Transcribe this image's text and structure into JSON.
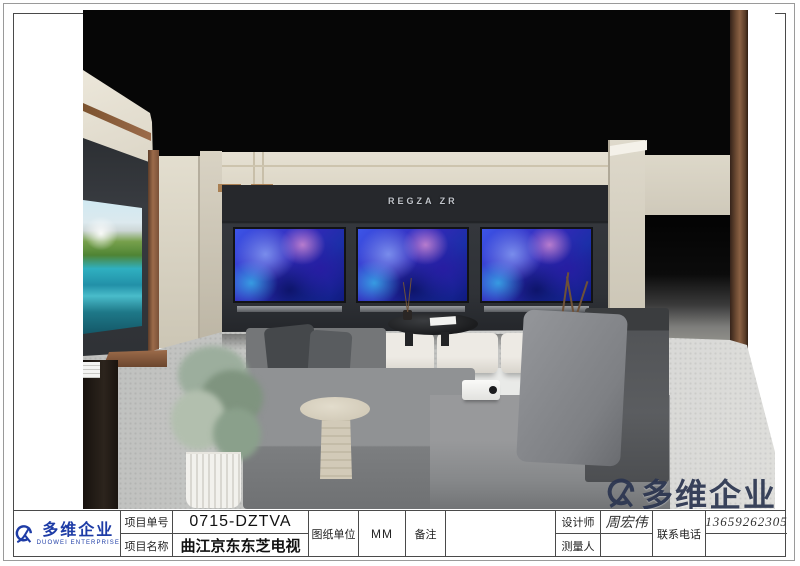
{
  "scene": {
    "brand_sign": "REGZA ZR",
    "watermark_text": "多维企业",
    "colors": {
      "logo_blue": "#1e3ca6",
      "watermark_navy": "#2b3550",
      "feature_wall_charcoal": "#2f3237",
      "wall_beige": "#e0dbcc",
      "copper_trim": "#8a5f42",
      "tv_art_blue": "#3328b8",
      "floor_gray": "#c8c9c7"
    }
  },
  "title_block": {
    "logo": {
      "name_cn": "多维企业",
      "name_en": "DUOWEI ENTERPRISE"
    },
    "project_no": {
      "label": "项目单号",
      "value": "0715-DZTVA"
    },
    "project_name": {
      "label": "项目名称",
      "value": "曲江京东东芝电视"
    },
    "drawing_unit": {
      "label": "图纸单位",
      "value": "MM"
    },
    "remark": {
      "label": "备注",
      "value": ""
    },
    "designer": {
      "label": "设计师",
      "value": "周宏伟"
    },
    "surveyor": {
      "label": "测量人",
      "value": ""
    },
    "phone": {
      "label": "联系电话",
      "value": "13659262305"
    }
  }
}
